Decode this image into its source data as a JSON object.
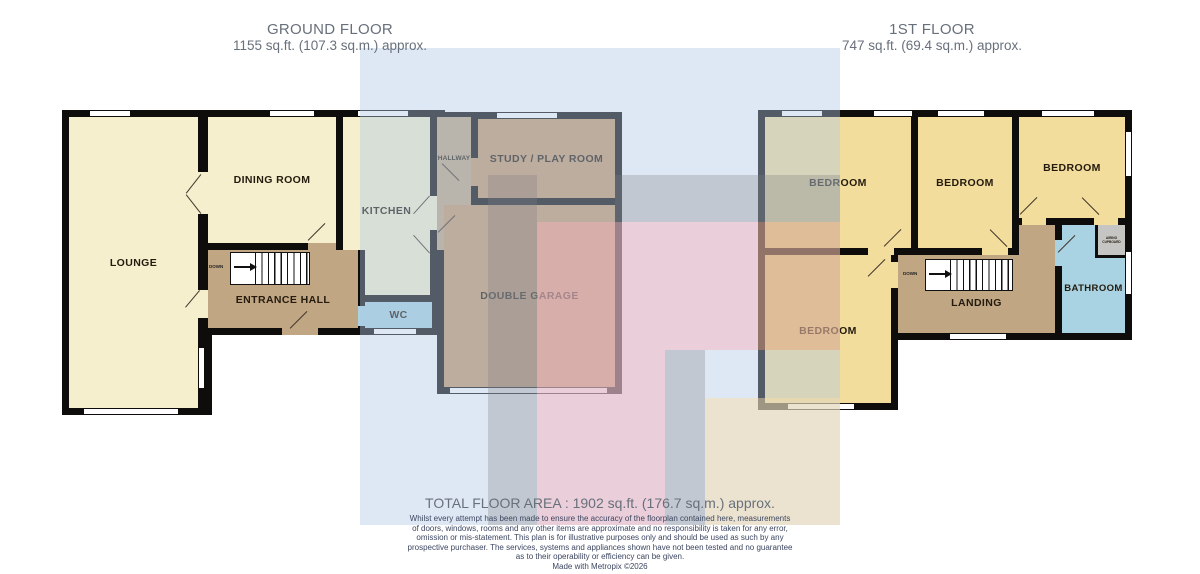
{
  "ground_floor": {
    "title": "GROUND FLOOR",
    "area": "1155 sq.ft. (107.3 sq.m.) approx.",
    "stairs_label": "DOWN",
    "rooms": {
      "lounge": "LOUNGE",
      "dining": "DINING ROOM",
      "kitchen": "KITCHEN",
      "hallway": "HALLWAY",
      "study": "STUDY / PLAY ROOM",
      "entrance": "ENTRANCE HALL",
      "wc": "WC",
      "garage": "DOUBLE GARAGE"
    }
  },
  "first_floor": {
    "title": "1ST FLOOR",
    "area": "747 sq.ft. (69.4 sq.m.) approx.",
    "stairs_label": "DOWN",
    "rooms": {
      "bedroom1": "BEDROOM",
      "bedroom2": "BEDROOM",
      "bedroom3": "BEDROOM",
      "bedroom4": "BEDROOM",
      "landing": "LANDING",
      "bathroom": "BATHROOM",
      "airing": "AIRING CUPBOARD"
    }
  },
  "footer": {
    "total_area": "TOTAL FLOOR AREA : 1902 sq.ft. (176.7 sq.m.) approx.",
    "disclaimer_lines": [
      "Whilst every attempt has been made to ensure the accuracy of the floorplan contained here, measurements",
      "of doors, windows, rooms and any other items are approximate and no responsibility is taken for any error,",
      "omission or mis-statement. This plan is for illustrative purposes only and should be used as such by any",
      "prospective purchaser. The services, systems and appliances shown have not been tested and no guarantee",
      "as to their operability or efficiency can be given.",
      "Made with Metropix ©2026"
    ]
  },
  "palette": {
    "wall": "#0e0d0b",
    "cream": "#f5efce",
    "tan": "#c69a6d",
    "taupe": "#c0a683",
    "room_blue": "#a9d2e2",
    "room_yellow": "#f2dd9c",
    "room_gray": "#c5c5c3",
    "overlay_blue": "rgba(176,200,229,0.42)",
    "overlay_gray": "rgba(125,125,128,0.30)",
    "overlay_pink": "rgba(248,175,185,0.45)",
    "overlay_cream": "rgba(250,222,165,0.45)",
    "overlay_orange": "rgba(240,155,105,0.40)"
  }
}
